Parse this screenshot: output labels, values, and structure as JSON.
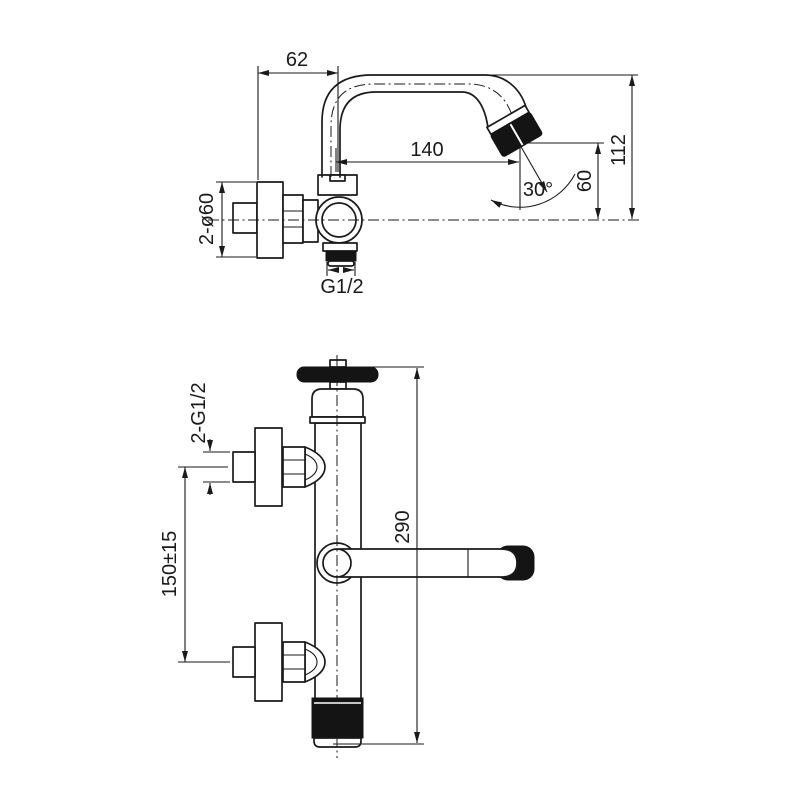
{
  "drawing": {
    "type": "technical-dimensional-drawing",
    "colors": {
      "line": "#1a1a1a",
      "solid_fill": "#141414",
      "background": "#ffffff"
    },
    "side_view": {
      "wall_offset": "62",
      "spout_reach": "140",
      "overall_height": "112",
      "outlet_height": "60",
      "outlet_angle": "30°",
      "flange_size": "2-ø60",
      "outlet_thread": "G1/2"
    },
    "front_view": {
      "inlet_thread": "2-G1/2",
      "inlet_spacing": "150±15",
      "overall_length": "290"
    }
  }
}
